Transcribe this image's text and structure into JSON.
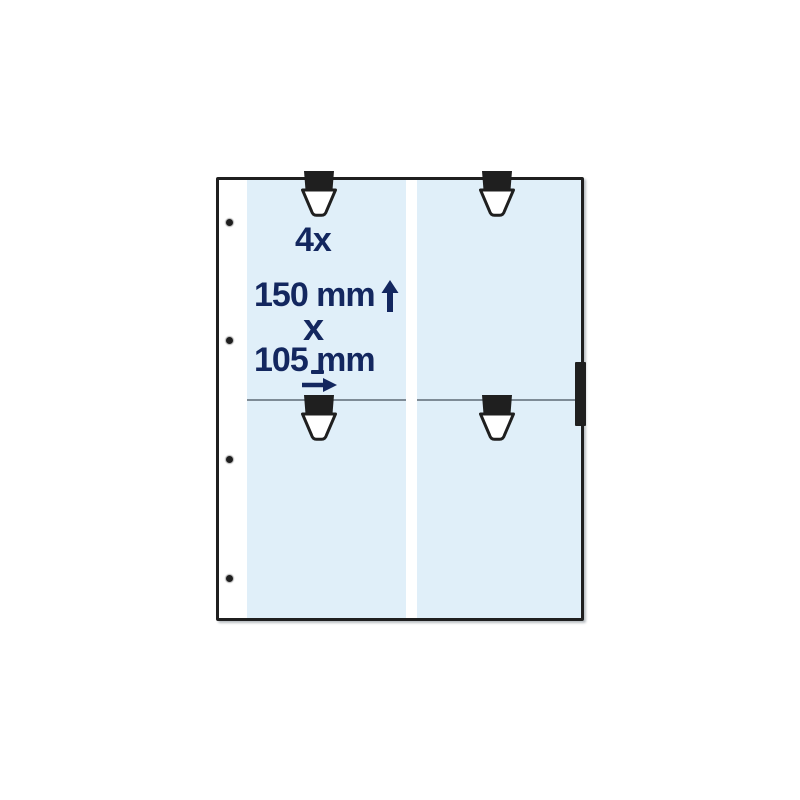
{
  "annotation": {
    "quantity_label": "4x",
    "height_label": "150 mm",
    "times_label": "x",
    "width_label": "105 mm",
    "underscore_mark": "_"
  },
  "icons": {
    "up_arrow": "↑",
    "right_arrow": "→",
    "binder_hole": "•",
    "pocket_tab": "clamp-tab"
  },
  "sheet": {
    "pocket_count": 4,
    "binder_hole_count": 4
  },
  "colors": {
    "pocket_fill": "#e0eff9",
    "annotation_text": "#13275f",
    "outline": "#1f1f1f",
    "divider": "#7e8b96",
    "background": "#ffffff"
  }
}
